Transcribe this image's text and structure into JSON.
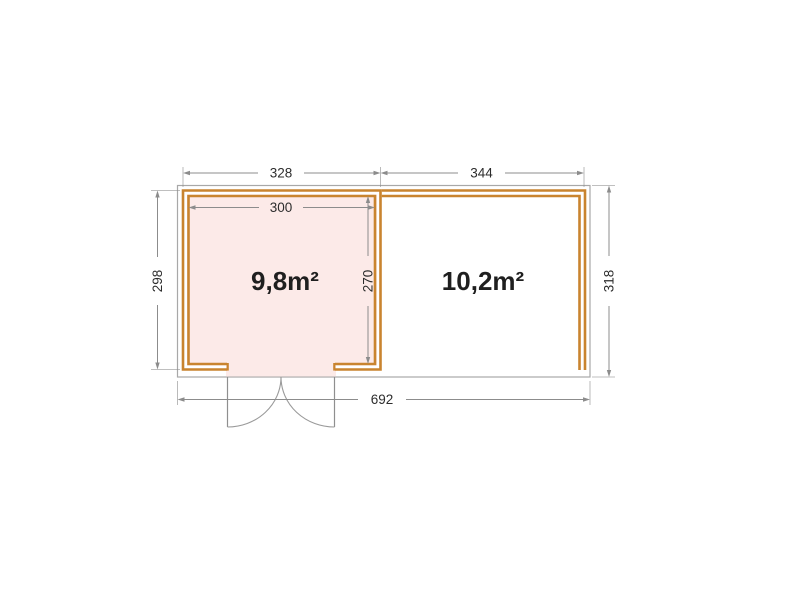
{
  "colors": {
    "wall": "#c9842f",
    "left_room_fill": "#fceae8",
    "outline": "#a8a8a8",
    "dimension_line": "#8c8c8c",
    "dimension_text": "#2d2d2d",
    "label_text": "#1f1f1f"
  },
  "floorplan": {
    "left_room": {
      "area_label": "9,8m²"
    },
    "right_room": {
      "area_label": "10,2m²"
    },
    "dimensions": {
      "left_outer_width": "328",
      "right_outer_width": "344",
      "left_inner_width": "300",
      "left_outer_depth": "298",
      "left_inner_depth": "270",
      "right_outer_depth": "318",
      "total_width": "692"
    }
  }
}
